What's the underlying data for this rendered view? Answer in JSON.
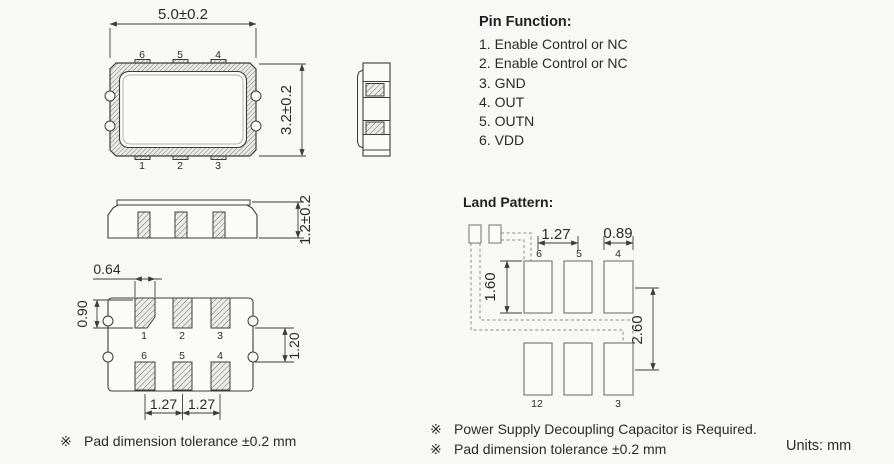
{
  "pin_function": {
    "title": "Pin Function:",
    "items": [
      "1. Enable Control or NC",
      "2. Enable Control or NC",
      "3. GND",
      "4. OUT",
      "5. OUTN",
      "6. VDD"
    ]
  },
  "top_view": {
    "width_dim": "5.0±0.2",
    "height_dim": "3.2±0.2",
    "pins_top": [
      "6",
      "5",
      "4"
    ],
    "pins_bottom": [
      "1",
      "2",
      "3"
    ]
  },
  "front_view": {
    "height_dim": "1.2±0.2"
  },
  "bottom_view": {
    "pad_width_dim": "0.64",
    "pad_height_dim": "0.90",
    "row_gap_dim": "1.20",
    "pitch_dim_left": "1.27",
    "pitch_dim_right": "1.27",
    "pins_row1": [
      "1",
      "2",
      "3"
    ],
    "pins_row2": [
      "6",
      "5",
      "4"
    ]
  },
  "land_pattern": {
    "title": "Land Pattern:",
    "pitch_dim": "1.27",
    "pad_width_dim": "0.89",
    "pad_height_dim": "1.60",
    "row_pitch_dim": "2.60",
    "labels_top": [
      "6",
      "5",
      "4"
    ],
    "labels_bottom": [
      "12",
      "3"
    ]
  },
  "notes": {
    "marker": "※",
    "left": "Pad dimension tolerance ±0.2 mm",
    "right_1": "Power Supply Decoupling Capacitor is Required.",
    "right_2": "Pad dimension tolerance ±0.2 mm",
    "units": "Units: mm"
  },
  "colors": {
    "line": "#3c3c3c",
    "text": "#2a2a2a",
    "bg": "#f8f8f6",
    "dashed": "#8a8a8a",
    "pad_border": "#7d7d7d"
  }
}
